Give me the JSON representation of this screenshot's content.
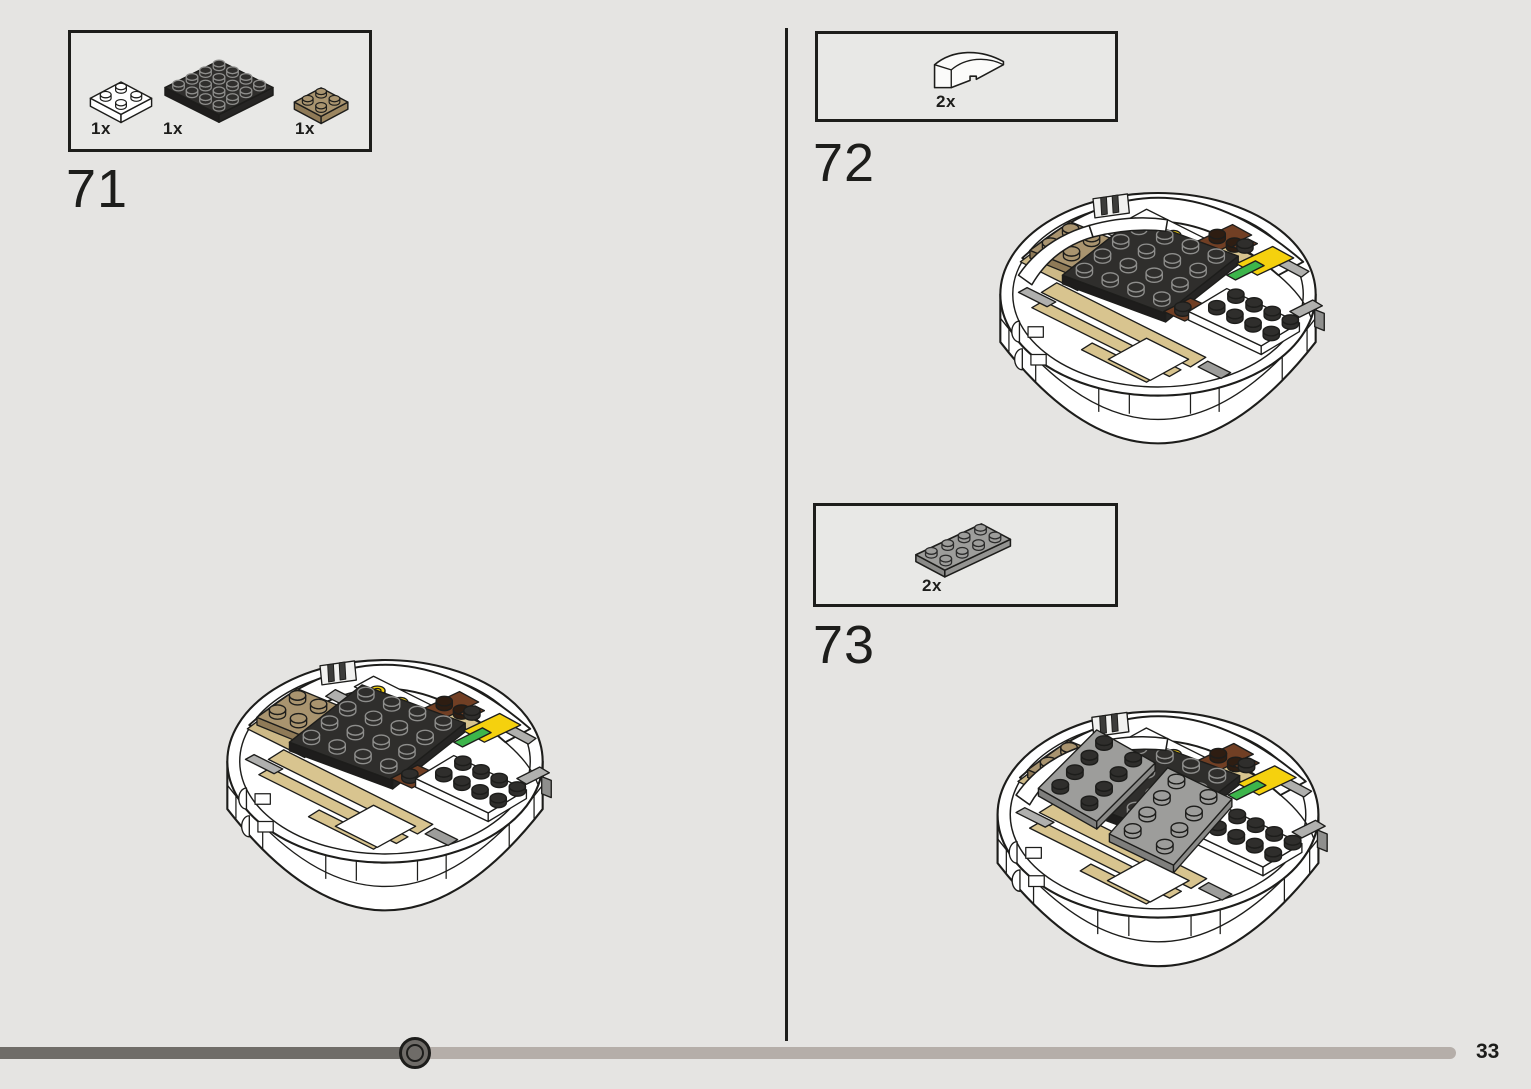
{
  "page": {
    "number": "33",
    "background": "#e5e4e2"
  },
  "steps": [
    {
      "number": "71",
      "parts": [
        {
          "qty": "1x",
          "name": "plate-2x2-white"
        },
        {
          "qty": "1x",
          "name": "plate-4x4-black"
        },
        {
          "qty": "1x",
          "name": "plate-2x2-dark-tan"
        }
      ]
    },
    {
      "number": "72",
      "parts": [
        {
          "qty": "2x",
          "name": "slope-curved-2x1-white"
        }
      ]
    },
    {
      "number": "73",
      "parts": [
        {
          "qty": "2x",
          "name": "plate-2x4-gray"
        }
      ]
    }
  ],
  "progress": {
    "fraction": 0.29
  },
  "colors": {
    "background": "#e5e4e2",
    "line": "#1d1d1b",
    "tan": "#d8c48f",
    "dark_tan": "#a9946f",
    "black_piece": "#2f2e2c",
    "brown": "#713f24",
    "yellow": "#f5d10e",
    "green": "#3db54b",
    "gray_piece": "#9d9d9b",
    "bar_dark": "#6f6c68",
    "bar_light": "#b5aea9"
  }
}
